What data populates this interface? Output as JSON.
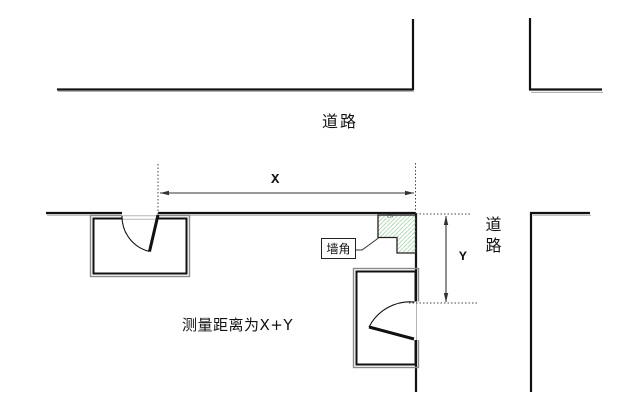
{
  "diagram": {
    "road_label_top": "道路",
    "road_label_right": "道路",
    "dim_x_label": "X",
    "dim_y_label": "Y",
    "wall_corner_label": "墙角",
    "measurement_note": "测量距离为X+Y",
    "corner_mark": "CA"
  },
  "colors": {
    "line": "#111111",
    "shadow": "#aaaaaa",
    "dim_line": "#333333",
    "hatch_green": "#a8d2a8",
    "background": "#ffffff"
  }
}
